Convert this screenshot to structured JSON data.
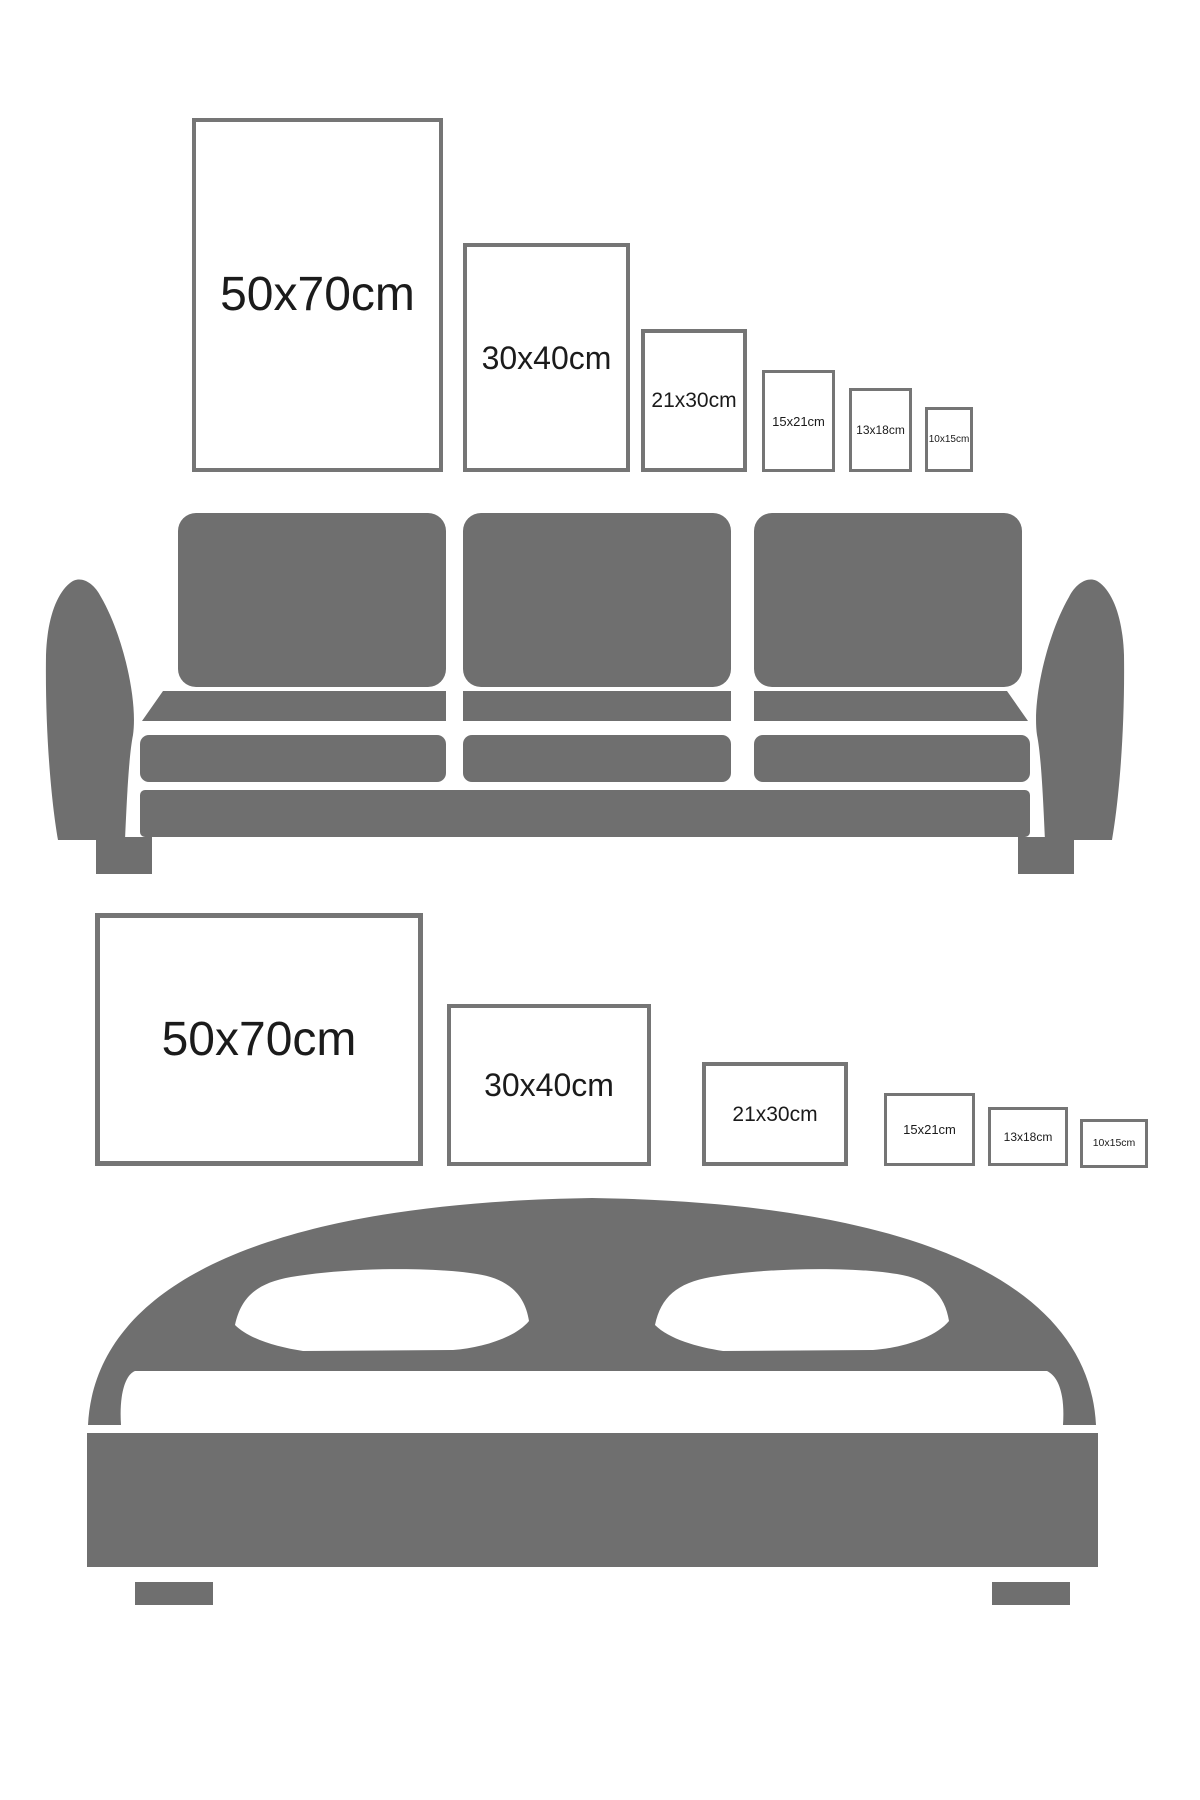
{
  "colors": {
    "background": "#ffffff",
    "frame_border": "#757575",
    "frame_fill": "#ffffff",
    "label_text": "#1b1b1b",
    "sofa_gray": "#6f6f6f",
    "bed_gray": "#6f6f6f"
  },
  "sections": [
    {
      "id": "portrait-sizes-over-sofa",
      "furniture": "sofa",
      "orientation": "portrait",
      "frames": [
        {
          "label": "50x70cm"
        },
        {
          "label": "30x40cm"
        },
        {
          "label": "21x30cm"
        },
        {
          "label": "15x21cm"
        },
        {
          "label": "13x18cm"
        },
        {
          "label": "10x15cm"
        }
      ]
    },
    {
      "id": "landscape-sizes-over-bed",
      "furniture": "bed",
      "orientation": "landscape",
      "frames": [
        {
          "label": "50x70cm"
        },
        {
          "label": "30x40cm"
        },
        {
          "label": "21x30cm"
        },
        {
          "label": "15x21cm"
        },
        {
          "label": "13x18cm"
        },
        {
          "label": "10x15cm"
        }
      ]
    }
  ]
}
